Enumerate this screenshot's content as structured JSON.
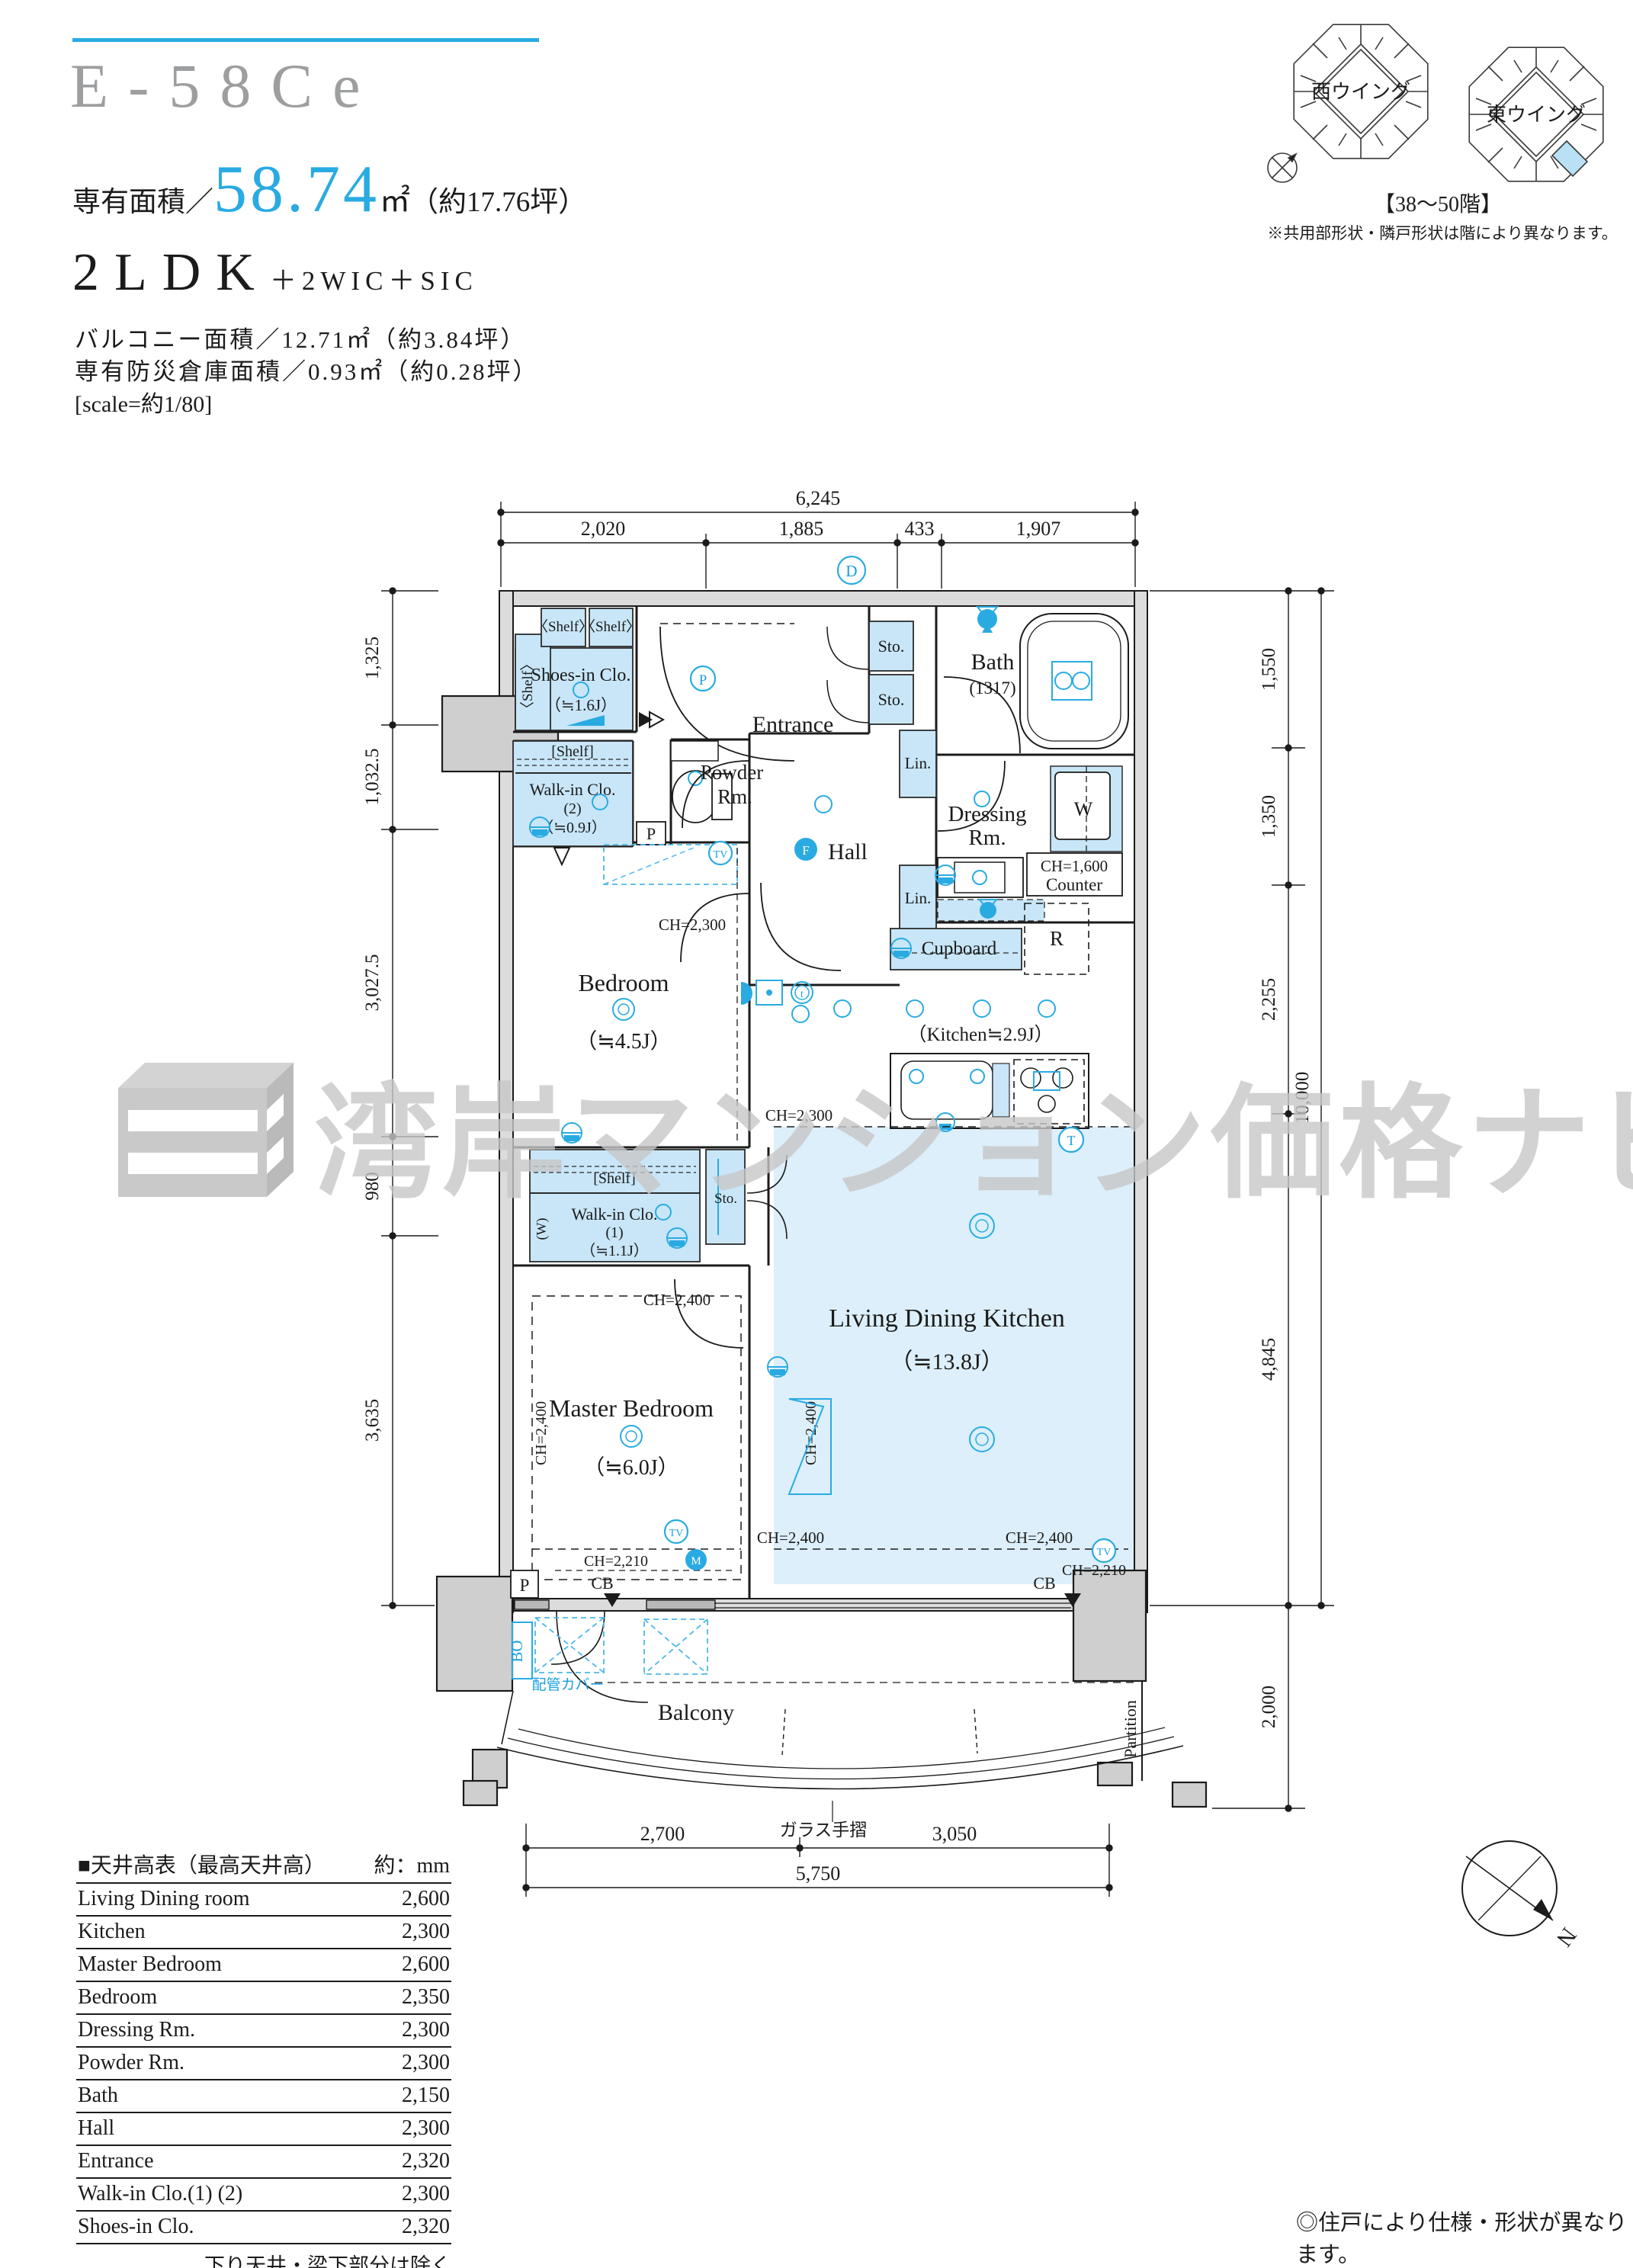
{
  "header": {
    "unit_code": "E-58Ce",
    "area_prefix": "専有面積／",
    "area_value": "58.74",
    "area_unit": "㎡",
    "area_tsubo": "（約17.76坪）",
    "layout": "2LDK",
    "layout_suffix": "＋2WIC＋SIC",
    "balcony_area": "バルコニー面積／12.71㎡（約3.84坪）",
    "disaster_storage": "専有防災倉庫面積／0.93㎡（約0.28坪）",
    "scale_note": "[scale=約1/80]"
  },
  "keyplan": {
    "west": "西ウイング",
    "east": "東ウイング",
    "floors": "【38～50階】",
    "note": "※共用部形状・隣戸形状は階により異なります。"
  },
  "watermark": {
    "text": "湾岸マンション価格ナビ"
  },
  "dims": {
    "top_total": "6,245",
    "top": [
      "2,020",
      "1,885",
      "433",
      "1,907"
    ],
    "left": [
      "1,325",
      "1,032.5",
      "3,027.5",
      "980",
      "3,635"
    ],
    "right": [
      "1,550",
      "1,350",
      "2,255",
      "4,845"
    ],
    "right_total": "10,000",
    "balcony_depth": "2,000",
    "bottom": [
      "2,700",
      "3,050"
    ],
    "bottom_total": "5,750"
  },
  "rooms": {
    "shoes_clo": "Shoes-in Clo.",
    "shoes_clo_size": "（≒1.6J）",
    "shelf_angled": "〈Shelf〉",
    "shelf_bracket": "[Shelf]",
    "entrance": "Entrance",
    "sto": "Sto.",
    "lin": "Lin.",
    "bath": "Bath",
    "bath_size": "(1317)",
    "powder_1": "Powder",
    "powder_2": "Rm.",
    "hall": "Hall",
    "dressing_1": "Dressing",
    "dressing_2": "Rm.",
    "washer": "W",
    "counter_ch": "CH=1,600",
    "counter": "Counter",
    "cupboard": "Cupboard",
    "fridge": "R",
    "kitchen": "（Kitchen≒2.9J）",
    "bedroom": "Bedroom",
    "bedroom_size": "（≒4.5J）",
    "wic": "Walk-in Clo.",
    "wic1_no": "(1)",
    "wic1_size": "（≒1.1J）",
    "wic2_no": "(2)",
    "wic2_size": "（≒0.9J）",
    "wic_w": "(W)",
    "master": "Master Bedroom",
    "master_size": "（≒6.0J）",
    "ldk": "Living Dining Kitchen",
    "ldk_size": "（≒13.8J）",
    "ch2300": "CH=2,300",
    "ch2400": "CH=2,400",
    "ch2210": "CH=2,210",
    "cb": "CB",
    "p": "P",
    "bo": "BO",
    "pipe_cover": "配管カバー",
    "balcony": "Balcony",
    "glass_rail": "ガラス手摺",
    "partition": "Partition"
  },
  "markers": {
    "d": "D",
    "p": "P",
    "f": "F",
    "t": "t",
    "tv": "TV",
    "m": "M",
    "th": "T",
    "n": "N"
  },
  "table": {
    "title": "■天井高表（最高天井高）",
    "unit": "約：mm",
    "rows": [
      [
        "Living Dining room",
        "2,600"
      ],
      [
        "Kitchen",
        "2,300"
      ],
      [
        "Master Bedroom",
        "2,600"
      ],
      [
        "Bedroom",
        "2,350"
      ],
      [
        "Dressing Rm.",
        "2,300"
      ],
      [
        "Powder Rm.",
        "2,300"
      ],
      [
        "Bath",
        "2,150"
      ],
      [
        "Hall",
        "2,300"
      ],
      [
        "Entrance",
        "2,320"
      ],
      [
        "Walk-in Clo.(1) (2)",
        "2,300"
      ],
      [
        "Shoes-in Clo.",
        "2,320"
      ]
    ],
    "footnote": "下り天井・梁下部分は除く"
  },
  "footer": {
    "note": "◎住戸により仕様・形状が異なります。"
  }
}
